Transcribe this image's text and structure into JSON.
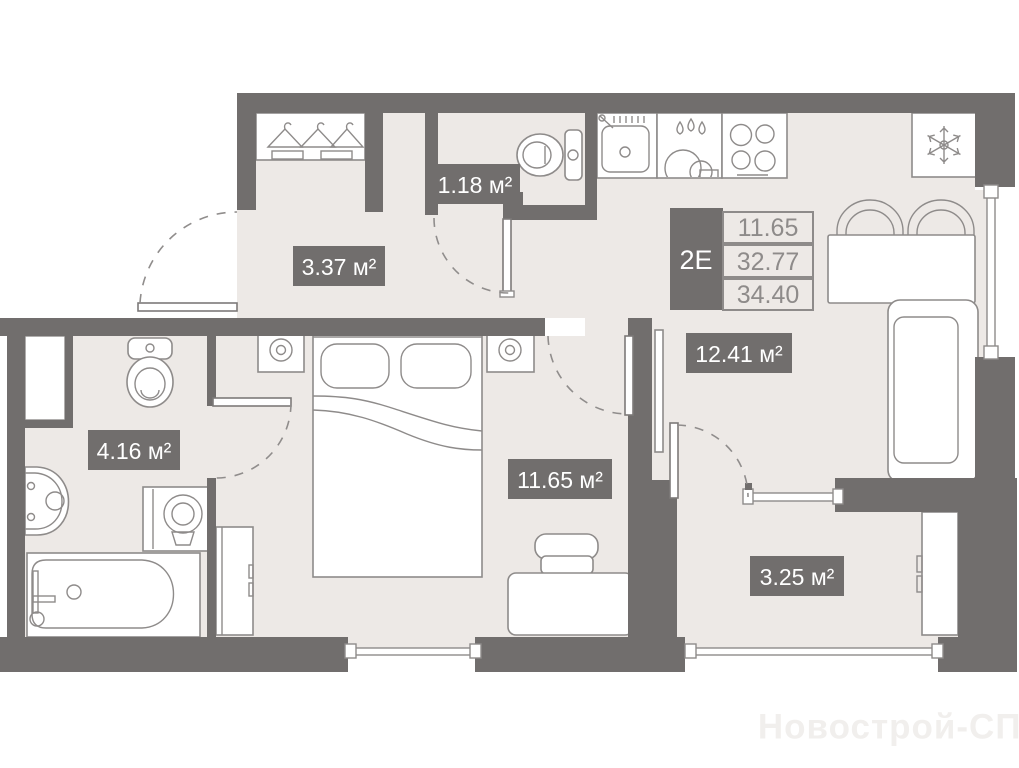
{
  "plan": {
    "title": "Apartment floor plan",
    "info_box": {
      "type": "2Е",
      "values": [
        "11.65",
        "32.77",
        "34.40"
      ]
    },
    "room_labels": {
      "wc": "1.18 м²",
      "hallway": "3.37 м²",
      "bathroom": "4.16 м²",
      "bedroom": "11.65 м²",
      "living": "12.41 м²",
      "loggia": "3.25 м²"
    },
    "watermark": "Новострой-СПб",
    "colors": {
      "wall": "#716E6D",
      "floor": "#EDE9E6",
      "outline": "#8E8B8A",
      "badge_text": "#FFFFFF",
      "value_text": "#8E8B8A",
      "watermark": "#F1EFED"
    },
    "icons": [
      "hanger-icon",
      "snowflake-icon",
      "water-drops-icon",
      "burner-icon",
      "lamp-icon",
      "toilet-icon",
      "bathtub-icon",
      "washer-icon",
      "sink-icon"
    ]
  }
}
